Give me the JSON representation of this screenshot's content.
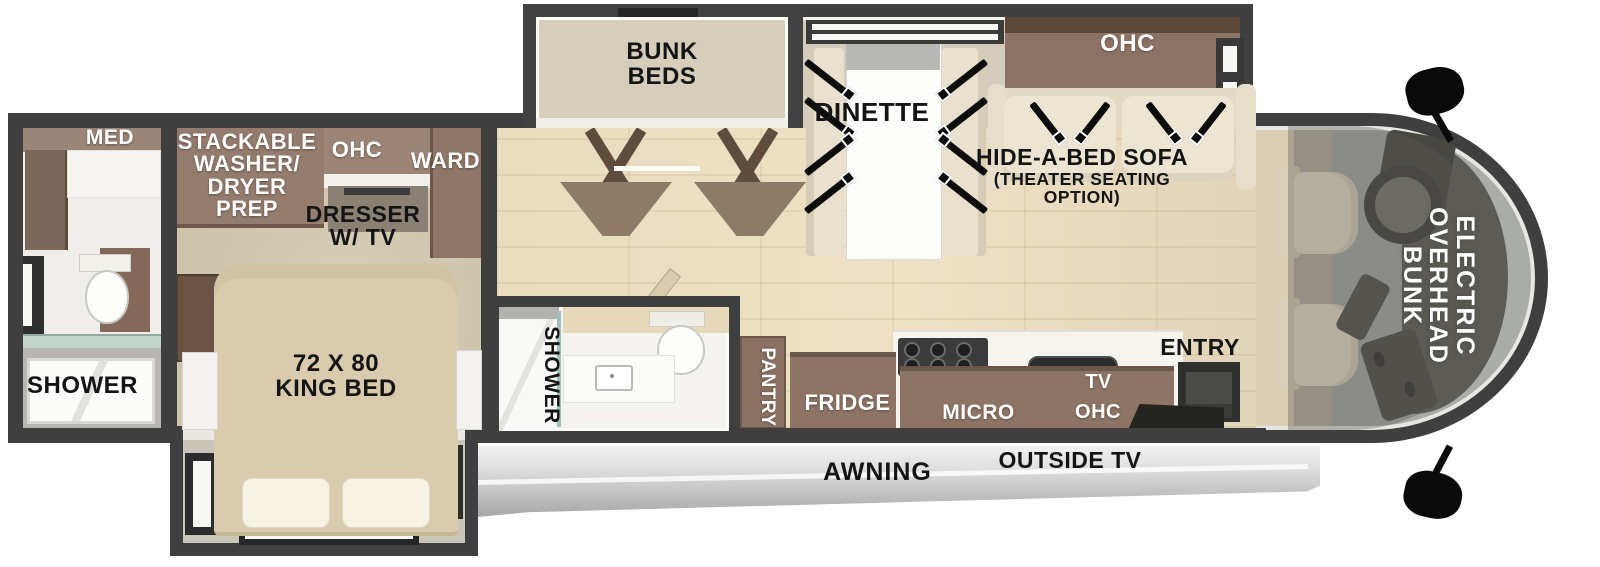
{
  "title": "Class A Motorhome Floorplan",
  "colors": {
    "wall": "#3f3f3f",
    "wood_floor": "#e9ddc0",
    "cabinet_brown": "#8d7465",
    "cabinet_mauve": "#9c8577",
    "upholstery_cream": "#ece5d2",
    "bed_tan": "#d9ccae",
    "awning_gray": "#cfcfcf",
    "windshield_gray": "#a9aca8",
    "label_black": "#141414",
    "label_white": "#ffffff"
  },
  "rooms": {
    "rear_bath": {
      "med_label": "MED",
      "shower_label": "SHOWER"
    },
    "bedroom": {
      "washer_label": "STACKABLE\nWASHER/\nDRYER\nPREP",
      "ohc_label": "OHC",
      "ward_label": "WARD",
      "dresser_label": "DRESSER\nW/ TV",
      "bed_label": "72 X 80\nKING BED"
    },
    "bunk_slide": {
      "label": "BUNK\nBEDS"
    },
    "living": {
      "dinette_label": "DINETTE",
      "ohc_label": "OHC",
      "sofa_label": "HIDE-A-BED SOFA",
      "sofa_sub1": "(THEATER SEATING",
      "sofa_sub2": "OPTION)"
    },
    "mid_bath": {
      "shower_label": "SHOWER"
    },
    "kitchen": {
      "pantry_label": "PANTRY",
      "fridge_label": "FRIDGE",
      "micro_label": "MICRO",
      "tv_label": "TV",
      "ohc_label": "OHC",
      "entry_label": "ENTRY"
    },
    "cab": {
      "overhead_bunk_label": "ELECTRIC\nOVERHEAD\nBUNK"
    },
    "exterior": {
      "awning_label": "AWNING",
      "outside_tv_label": "OUTSIDE TV"
    }
  }
}
